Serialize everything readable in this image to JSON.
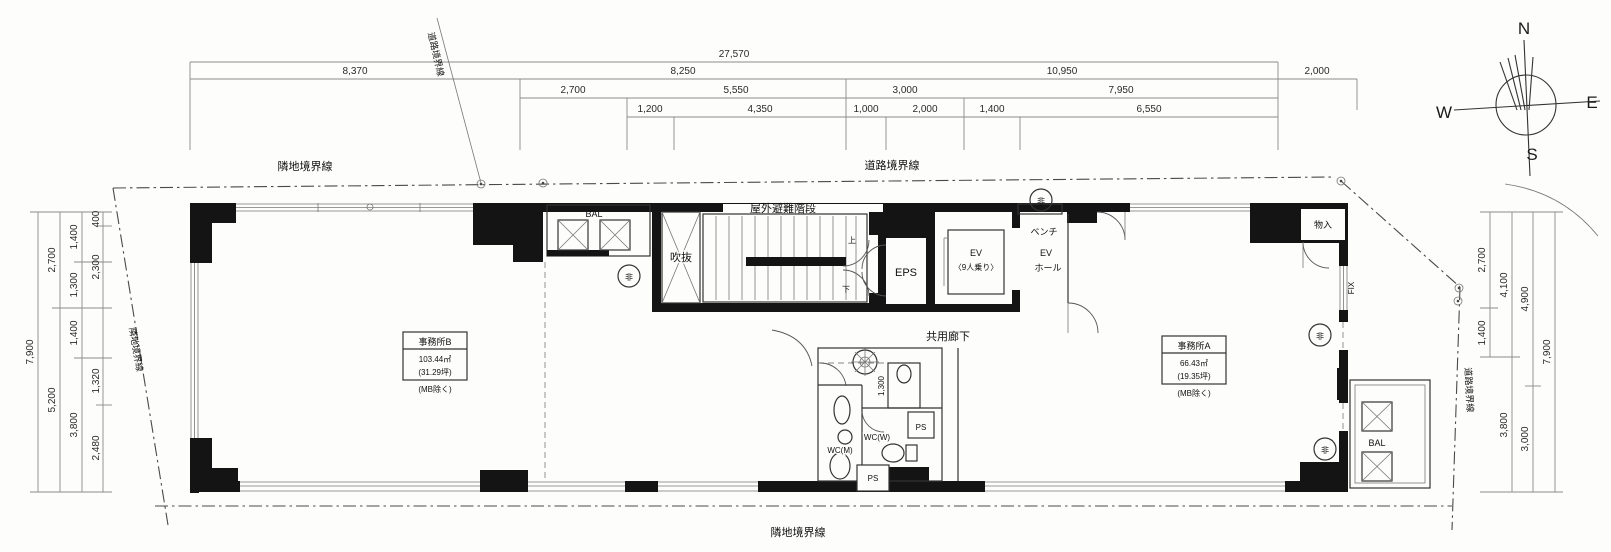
{
  "compass": {
    "north": "N",
    "south": "S",
    "east": "E",
    "west": "W"
  },
  "boundaries": {
    "top_left": "隣地境界線",
    "top_right": "道路境界線",
    "top_slant": "道路境界線",
    "left_slant": "隣地境界線",
    "right_slant": "道路境界線",
    "bottom": "隣地境界線"
  },
  "rooms": {
    "office_b_name": "事務所B",
    "office_b_area": "103.44㎡",
    "office_b_tsubo": "(31.29坪)",
    "office_b_note": "(MB除く)",
    "office_a_name": "事務所A",
    "office_a_area": "66.43㎡",
    "office_a_tsubo": "(19.35坪)",
    "office_a_note": "(MB除く)",
    "outdoor_stairs": "屋外避難階段",
    "void": "吹抜",
    "balcony_top": "BAL",
    "balcony_right": "BAL",
    "eps": "EPS",
    "ev": "EV",
    "ev_capacity": "〈9人乗り〉",
    "ev_hall_line1": "EV",
    "ev_hall_line2": "ホール",
    "bench": "ベンチ",
    "corridor": "共用廊下",
    "storage": "物入",
    "fix_window": "FIX",
    "wc_m": "WC(M)",
    "wc_w": "WC(W)",
    "ps_upper": "PS",
    "ps_lower": "PS",
    "stairs_up": "上",
    "stairs_down": "下",
    "emergency": "非"
  },
  "dimensions": {
    "top_row1": [
      "27,570"
    ],
    "top_row2": [
      "8,370",
      "8,250",
      "10,950",
      "2,000"
    ],
    "top_row3": [
      "2,700",
      "5,550",
      "3,000",
      "7,950"
    ],
    "top_row4": [
      "1,200",
      "4,350",
      "1,000",
      "2,000",
      "1,400",
      "6,550"
    ],
    "left_total": [
      "7,900"
    ],
    "left_mid": [
      "2,700",
      "5,200"
    ],
    "left_inner": [
      "1,400",
      "1,300",
      "1,400",
      "3,800"
    ],
    "left_innermost": [
      "400",
      "2,300",
      "1,320",
      "2,480"
    ],
    "right_inner": [
      "2,700",
      "1,400"
    ],
    "right_mid": [
      "4,100",
      "3,800"
    ],
    "right_outer": [
      "4,900",
      "3,000"
    ],
    "right_total": [
      "7,900"
    ],
    "interior_wc": "1,300"
  }
}
